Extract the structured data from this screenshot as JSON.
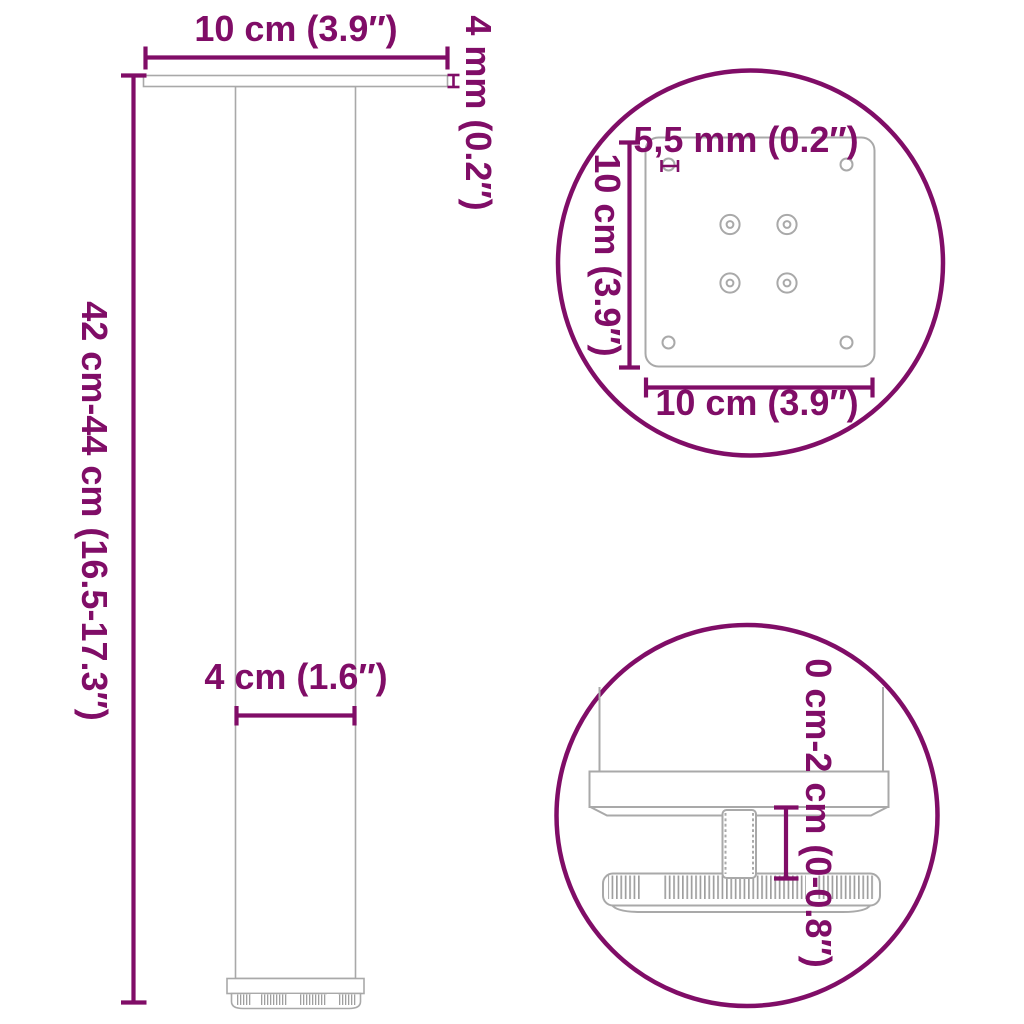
{
  "colors": {
    "accent": "#800d67",
    "outline": "#a9a9a9"
  },
  "main_view": {
    "top_width": "10 cm (3.9″)",
    "plate_thickness": "4 mm (0.2″)",
    "height_range": "42 cm-44 cm (16.5-17.3″)",
    "leg_diameter": "4 cm (1.6″)"
  },
  "top_detail_circle": {
    "hole_diameter": "5,5 mm (0.2″)",
    "plate_depth": "10 cm (3.9″)",
    "plate_width": "10 cm (3.9″)"
  },
  "bottom_detail_circle": {
    "adjust_range": "0 cm-2 cm (0-0.8″)"
  }
}
